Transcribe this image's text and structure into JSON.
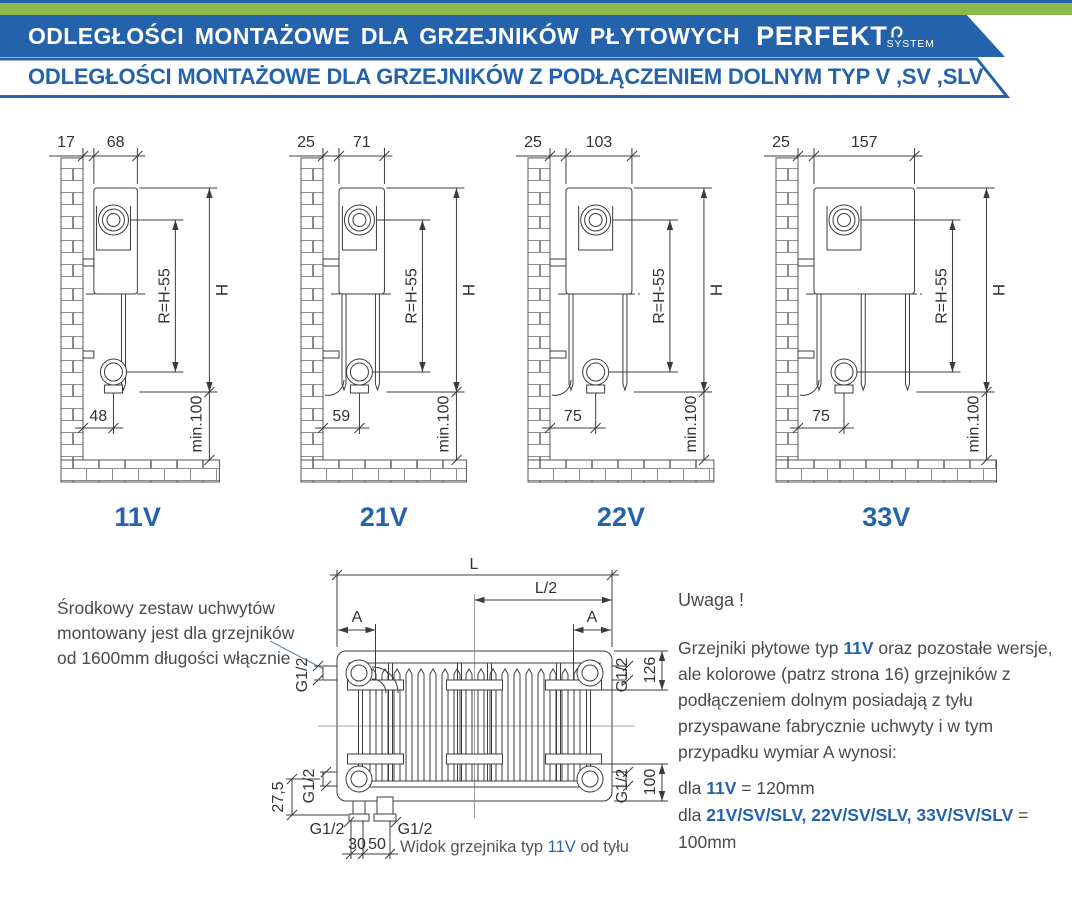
{
  "header": {
    "banner_title": "ODLEGŁOŚCI MONTAŻOWE DLA GRZEJNIKÓW PŁYTOWYCH",
    "brand": "PERFEKT",
    "brand_sub": "SYSTEM",
    "subtitle": "ODLEGŁOŚCI MONTAŻOWE DLA GRZEJNIKÓW Z PODŁĄCZENIEM DOLNYM TYP V ,SV ,SLV"
  },
  "colors": {
    "brand_blue": "#2463ac",
    "accent_green": "#8fb84a",
    "drawing_ink": "#3c3c3c",
    "body_text": "#4a4a4a"
  },
  "diagrams": [
    {
      "label": "11V",
      "wall_gap": "17",
      "depth": "68",
      "inner_dim": "R=H-55",
      "height_dim": "H",
      "pipe_offset": "48",
      "floor_clearance": "min.100",
      "panels": 1
    },
    {
      "label": "21V",
      "wall_gap": "25",
      "depth": "71",
      "inner_dim": "R=H-55",
      "height_dim": "H",
      "pipe_offset": "59",
      "floor_clearance": "min.100",
      "panels": 2
    },
    {
      "label": "22V",
      "wall_gap": "25",
      "depth": "103",
      "inner_dim": "R=H-55",
      "height_dim": "H",
      "pipe_offset": "75",
      "floor_clearance": "min.100",
      "panels": 2
    },
    {
      "label": "33V",
      "wall_gap": "25",
      "depth": "157",
      "inner_dim": "R=H-55",
      "height_dim": "H",
      "pipe_offset": "75",
      "floor_clearance": "min.100",
      "panels": 3
    }
  ],
  "rear_view": {
    "dim_L": "L",
    "dim_L2": "L/2",
    "dim_A_left": "A",
    "dim_A_right": "A",
    "thread": "G1/2",
    "dim_126": "126",
    "dim_100": "100",
    "dim_275": "27,5",
    "dim_30": "30",
    "dim_50": "50",
    "caption": [
      {
        "t": "Widok grzejnika typ "
      },
      {
        "t": "11V",
        "hl": true
      },
      {
        "t": " od tyłu"
      }
    ]
  },
  "note_left": {
    "text": "Środkowy zestaw uchwytów montowany jest dla grzejników od 1600mm długości włącznie"
  },
  "note_right": {
    "title": "Uwaga !",
    "body": [
      {
        "t": "Grzejniki płytowe typ "
      },
      {
        "t": "11V",
        "hl": true
      },
      {
        "t": " oraz pozostałe wersje, ale kolorowe (patrz strona 16) grzejników z podłączeniem dolnym posiadają z tyłu przyspawane fabrycznie uchwyty i w tym przypadku wymiar A wynosi:"
      }
    ],
    "lines": [
      [
        {
          "t": "dla "
        },
        {
          "t": "11V",
          "hl": true
        },
        {
          "t": " = 120mm"
        }
      ],
      [
        {
          "t": "dla "
        },
        {
          "t": "21V/SV/SLV, 22V/SV/SLV, 33V/SV/SLV",
          "hl": true
        },
        {
          "t": " = 100mm"
        }
      ]
    ]
  }
}
